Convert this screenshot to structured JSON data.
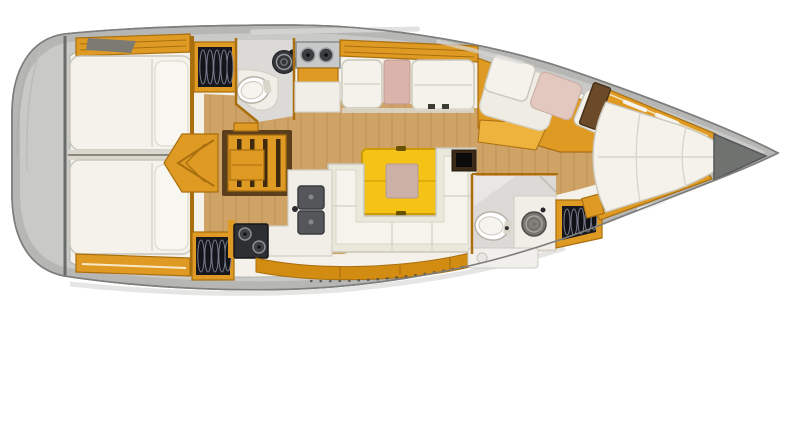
{
  "title": "Sailing yacht interior layout plan (top view, bow to the right)",
  "colors": {
    "hull": "#b6b6b4",
    "hullEdge": "#7e7e7c",
    "deckLight": "#c9c9c7",
    "ivory": "#f3f1e9",
    "floor": "#cfa265",
    "plank": "rgba(101,62,12,0.10)",
    "amber": "#df9a24",
    "amberLight": "#eeb33c",
    "amberDeep": "#d28c12",
    "amberDark": "#a96f0e",
    "tableYellow": "#f5c316",
    "tableEdge": "#cc9b04",
    "insetPink": "#ccb0a5",
    "cushionPink": "#dab4ab",
    "cushionPinkEdge": "#c1998f",
    "mattress": "#f4f2ea",
    "mattressEdge": "#c9c6ba",
    "seam": "#d8d5ca",
    "wardrobeDark": "#17181e",
    "hangerLight": "#787d8e",
    "steel": "#c7c9c9",
    "steelDark": "#85878a",
    "applianceDark": "#2e2f33",
    "sinkGray": "#54565a",
    "headFloor": "#dbdad6",
    "counter": "#f0eee7",
    "counterEdge": "#d2cfc6",
    "anchorGray": "#70726f",
    "darkWood": "#5b3f1c",
    "shadow": "#d0d0ce"
  },
  "areas": [
    "stern-platform",
    "aft-cabin-port-berth",
    "aft-cabin-starboard-berth",
    "hanging-wardrobe-port",
    "hanging-wardrobe-starboard",
    "companionway-steps",
    "aft-head-toilet",
    "aft-head-washbasin",
    "galley-stove-top",
    "saloon-settee-port",
    "saloon-table",
    "saloon-settee-starboard-u-shape",
    "galley-twin-sinks",
    "galley-oven",
    "forward-head-toilet",
    "forward-head-washbasin",
    "hanging-locker-forward",
    "lounge-chaise",
    "forward-cabin-v-berth",
    "anchor-locker"
  ]
}
